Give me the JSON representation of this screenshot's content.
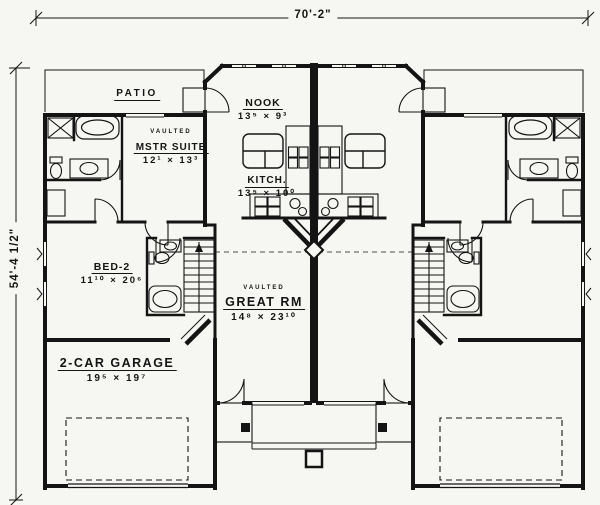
{
  "colors": {
    "background": "#f6f6f3",
    "line": "#141414"
  },
  "dimensions": {
    "top": "70'-2\"",
    "left": "54'-4 1/2\""
  },
  "rooms": {
    "patio": {
      "name": "PATIO"
    },
    "nook": {
      "name": "NOOK",
      "dims": "13⁵ × 9³"
    },
    "master_suite": {
      "prefix": "VAULTED",
      "name": "MSTR SUITE",
      "dims": "12¹ × 13³"
    },
    "kitchen": {
      "name": "KITCH.",
      "dims": "13⁵ × 10⁰"
    },
    "bed2": {
      "name": "BED-2",
      "dims": "11¹⁰ × 20⁶"
    },
    "great_room": {
      "prefix": "VAULTED",
      "name": "GREAT RM",
      "dims": "14⁸ × 23¹⁰"
    },
    "garage": {
      "name": "2-CAR GARAGE",
      "dims": "19⁵ × 19⁷"
    }
  }
}
